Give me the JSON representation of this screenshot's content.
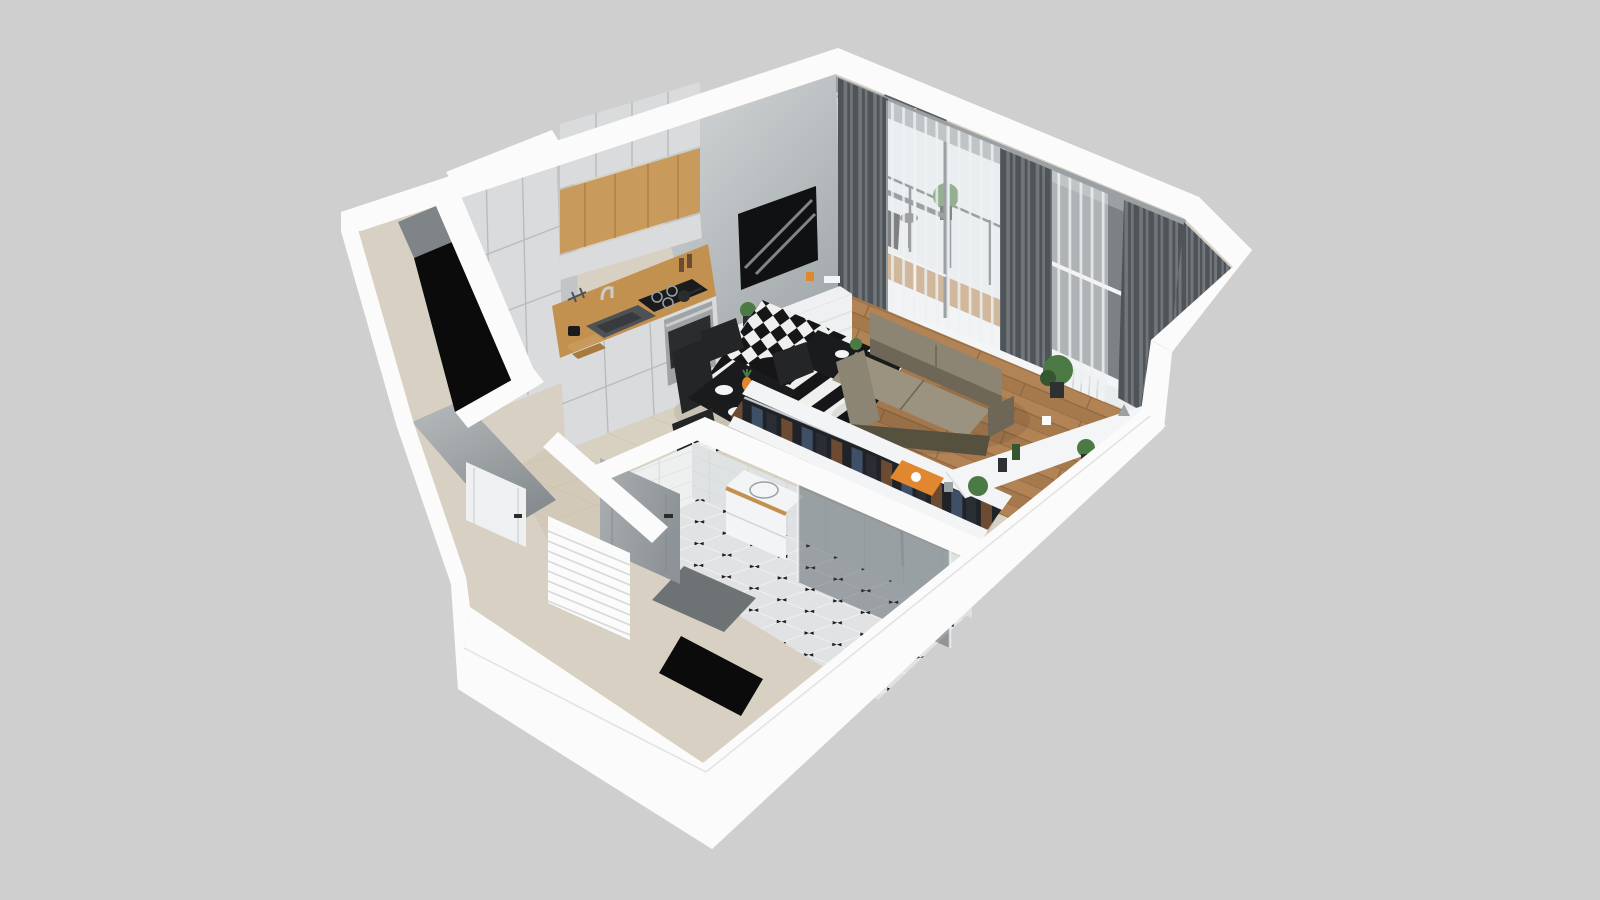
{
  "scene": {
    "description": "3D dollhouse-style cutaway floor plan render of a studio apartment",
    "rooms": [
      "kitchen",
      "dining-area",
      "living-room",
      "bathroom",
      "hallway",
      "balcony",
      "utility-shaft"
    ],
    "objects": {
      "kitchen": [
        "tall-cabinets",
        "upper-cabinets",
        "wood-niche",
        "wood-countertop",
        "sink",
        "faucet",
        "cooktop",
        "pans",
        "oven",
        "cutting-boards",
        "pepper-mills"
      ],
      "dining_area": [
        "black-dining-table",
        "black-chairs",
        "plates",
        "pineapple"
      ],
      "living_room": [
        "tv",
        "tv-cabinet",
        "striped-rug",
        "black-coffee-table",
        "taupe-sofa",
        "open-clothes-rack",
        "hanging-clothes",
        "black-floor-lamp",
        "window-sill-console",
        "orange-tray",
        "potted-plants",
        "vases"
      ],
      "window_wall": [
        "gray-curtains",
        "sheer-curtains",
        "balcony-door",
        "second-window",
        "radiator",
        "curtain-rail"
      ],
      "balcony": [
        "bistro-chair",
        "bistro-table",
        "balcony-plant",
        "glass-railing",
        "wood-decking"
      ],
      "bathroom": [
        "vanity-with-sink",
        "glass-shower",
        "shower-set",
        "gray-door",
        "subway-tile-walls",
        "octagon-tile-floor",
        "gray-bath-mat"
      ],
      "hallway": [
        "white-interior-door",
        "white-slatted-cabinet",
        "beige-tile-floor",
        "entry-opening"
      ]
    }
  },
  "colors": {
    "background": "#cfcfcf",
    "capWhite": "#fbfbfb",
    "capEdge": "#e2e2e2",
    "facadeLight": "#f6f6f6",
    "facadeMid": "#efefef",
    "facadeShade": "#e6e6e6",
    "facadeDark": "#dedede",
    "interiorBase": "#d8d1c3",
    "wallGrayLight": "#d7dadb",
    "wallGrayDark": "#a2a8ab",
    "wallHallLight": "#b7bbbd",
    "wallHallDark": "#868c8f",
    "shaftGray": "#7e8487",
    "black": "#0b0b0c",
    "kitchenTile": "#d8d1c1",
    "kitchenTileSeam": "#c7bfae",
    "hallTile": "#d3c9b8",
    "woodFloorA": "#b28355",
    "woodFloorB": "#a5794c",
    "woodSeam": "#8f6740",
    "counterWood": "#c3914f",
    "woodPanelA": "#c89a5b",
    "woodPanelB": "#a87a3e",
    "cabinetFront": "#d9dbdc",
    "cabinetSide": "#c2c5c7",
    "cabinetSeam": "#b9bcbe",
    "ovenSteel": "#9fa3a5",
    "ovenDark": "#2a2c2e",
    "cooktopBlack": "#1a1b1d",
    "sinkGray": "#4e5255",
    "chrome": "#c9cdcf",
    "tvBlack": "#101113",
    "tvUnit": "#eef0f1",
    "tvUnitShade": "#dfe2e3",
    "sofaMain": "#8d8573",
    "sofaShadow": "#6e6757",
    "sofaLight": "#9b937f",
    "sofaBase": "#56503f",
    "rugBlack": "#161618",
    "rugWhite": "#efefed",
    "tableBlack": "#1a1b1d",
    "chairBlack": "#232527",
    "curtain": "#70767a",
    "curtainDark": "#4e5458",
    "sheer": "#eef1f2",
    "glass": "#e9edee",
    "glassDark": "#7b8184",
    "frameDark": "#5a5f62",
    "frameLight": "#f4f5f6",
    "railGray": "#9aa0a3",
    "balconyWood": "#b98a55",
    "tileWall": "#eef0f0",
    "tileWallShade": "#dfe2e3",
    "tileSeam": "#d3d6d7",
    "bathFloor": "#e0e2e3",
    "bathFloorSeam": "#f2f3f3",
    "bathDot": "#1c1d1e",
    "showerGlass": "#3a464c",
    "doorGrayA": "#a9afb2",
    "doorGrayB": "#8d9396",
    "matGray": "#6d7275",
    "vanityWhite": "#f2f4f5",
    "rackFrame": "#f3f4f5",
    "rackInner": "#1f2226",
    "denim": "#3e4f66",
    "clothesDark": "#2a2d33",
    "clothesBrown": "#6d4b32",
    "orange": "#e0872f",
    "plantGreen": "#4c7a44",
    "plantDark": "#35562f",
    "potDark": "#2e3134",
    "radiatorWhite": "#f0f2f3",
    "shadow": "#000000"
  }
}
